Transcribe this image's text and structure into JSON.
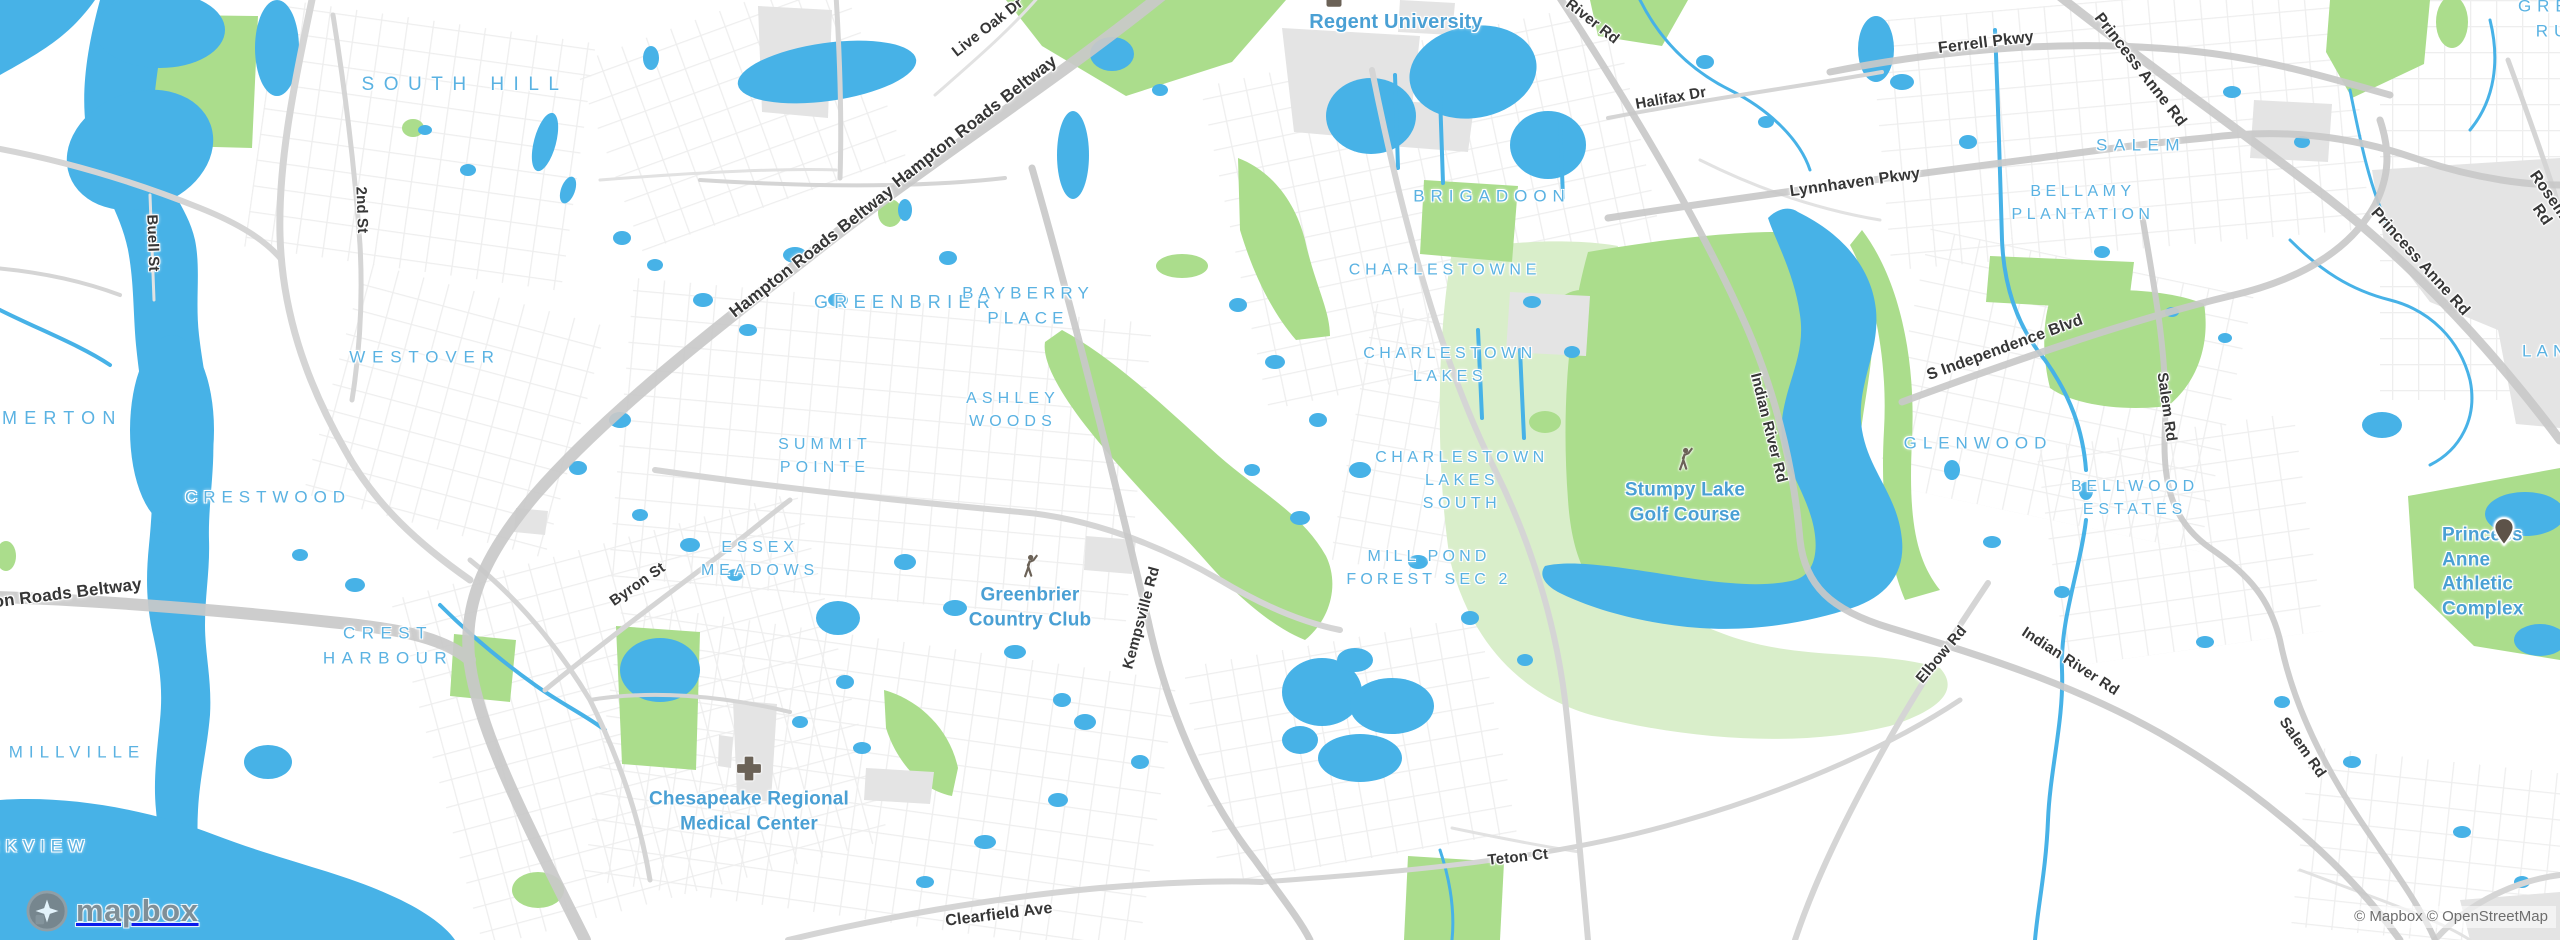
{
  "map": {
    "attribution": "© Mapbox © OpenStreetMap",
    "logo_text": "mapbox",
    "colors": {
      "water": "#47b2e7",
      "park": "#abdd8c",
      "park_light": "#d9eeca",
      "urban": "#e4e4e4",
      "road_major": "#c9c9c9",
      "road": "#d5d5d5",
      "road_minor": "#e2e2e2",
      "label_area": "#5ab2e2",
      "label_poi": "#4aa0d4",
      "label_road": "#363636",
      "icon_brown": "#6b6257",
      "pin_brown": "#5d5349",
      "attribution_gray": "#6e6e6e"
    },
    "area_labels": [
      {
        "text": "SOUTH HILL",
        "x": 465,
        "y": 85,
        "size": 19,
        "ls": 0.5
      },
      {
        "text": "MERTON",
        "x": 2,
        "y": 418,
        "size": 18,
        "ls": 0.4,
        "align": "left"
      },
      {
        "text": "WESTOVER",
        "x": 425,
        "y": 358,
        "size": 17,
        "ls": 0.4
      },
      {
        "text": "CRESTWOOD",
        "x": 268,
        "y": 498,
        "size": 17,
        "ls": 0.35
      },
      {
        "text": "CREST\nHARBOUR",
        "x": 388,
        "y": 646,
        "size": 17,
        "ls": 0.38
      },
      {
        "text": "MILLVILLE",
        "x": 77,
        "y": 753,
        "size": 17,
        "ls": 0.35
      },
      {
        "text": "PARKVIEW",
        "x": -46,
        "y": 847,
        "size": 17,
        "ls": 0.35,
        "align": "left"
      },
      {
        "text": "GREENBRIER",
        "x": 905,
        "y": 302,
        "size": 18,
        "ls": 0.35
      },
      {
        "text": "BAYBERRY\nPLACE",
        "x": 1028,
        "y": 306,
        "size": 17,
        "ls": 0.3
      },
      {
        "text": "ASHLEY\nWOODS",
        "x": 1013,
        "y": 410,
        "size": 16,
        "ls": 0.32
      },
      {
        "text": "SUMMIT\nPOINTE",
        "x": 825,
        "y": 456,
        "size": 16,
        "ls": 0.32
      },
      {
        "text": "ESSEX\nMEADOWS",
        "x": 760,
        "y": 559,
        "size": 16,
        "ls": 0.3
      },
      {
        "text": "BRIGADOON",
        "x": 1492,
        "y": 197,
        "size": 17,
        "ls": 0.35
      },
      {
        "text": "CHARLESTOWNE",
        "x": 1445,
        "y": 270,
        "size": 16,
        "ls": 0.3
      },
      {
        "text": "CHARLESTOWN\nLAKES",
        "x": 1450,
        "y": 365,
        "size": 16,
        "ls": 0.28
      },
      {
        "text": "CHARLESTOWN\nLAKES\nSOUTH",
        "x": 1462,
        "y": 481,
        "size": 16,
        "ls": 0.28
      },
      {
        "text": "MILL POND\nFOREST SEC 2",
        "x": 1429,
        "y": 568,
        "size": 16,
        "ls": 0.26
      },
      {
        "text": "GLENWOOD",
        "x": 1978,
        "y": 444,
        "size": 17,
        "ls": 0.35
      },
      {
        "text": "BELLWOOD\nESTATES",
        "x": 2135,
        "y": 498,
        "size": 16,
        "ls": 0.3
      },
      {
        "text": "SALEM",
        "x": 2141,
        "y": 146,
        "size": 17,
        "ls": 0.38
      },
      {
        "text": "BELLAMY\nPLANTATION",
        "x": 2083,
        "y": 203,
        "size": 16,
        "ls": 0.28
      },
      {
        "text": "GREEN RUN",
        "x": 2518,
        "y": 19,
        "size": 17,
        "ls": 0.35,
        "align": "left"
      },
      {
        "text": "LANDSTOWN",
        "x": 2522,
        "y": 352,
        "size": 17,
        "ls": 0.3,
        "align": "left"
      }
    ],
    "road_labels": [
      {
        "text": "Hampton Roads Beltway",
        "x": 975,
        "y": 122,
        "rot": -38,
        "size": 17
      },
      {
        "text": "Hampton Roads Beltway",
        "x": 812,
        "y": 252,
        "rot": -38,
        "size": 17
      },
      {
        "text": "Hampton Roads Beltway",
        "x": 41,
        "y": 597,
        "rot": -7,
        "size": 17
      },
      {
        "text": "Live Oak Dr",
        "x": 988,
        "y": 28,
        "rot": -38
      },
      {
        "text": "River Rd",
        "x": 1592,
        "y": 22,
        "rot": 38
      },
      {
        "text": "Ferrell Pkwy",
        "x": 1986,
        "y": 43,
        "rot": -7,
        "size": 16
      },
      {
        "text": "Princess Anne Rd",
        "x": 2140,
        "y": 70,
        "rot": 52,
        "size": 16
      },
      {
        "text": "Princess Anne Rd",
        "x": 2420,
        "y": 262,
        "rot": 48,
        "size": 16
      },
      {
        "text": "S Rosemont Rd",
        "x": 2556,
        "y": 205,
        "rot": 55,
        "size": 16
      },
      {
        "text": "Halifax Dr",
        "x": 1671,
        "y": 99,
        "rot": -10
      },
      {
        "text": "Lynnhaven Pkwy",
        "x": 1855,
        "y": 183,
        "rot": -8,
        "size": 16
      },
      {
        "text": "S Independence Blvd",
        "x": 2005,
        "y": 348,
        "rot": -20,
        "size": 16
      },
      {
        "text": "Indian River Rd",
        "x": 1768,
        "y": 428,
        "rot": 76
      },
      {
        "text": "Indian River Rd",
        "x": 2070,
        "y": 662,
        "rot": 33
      },
      {
        "text": "Salem Rd",
        "x": 2166,
        "y": 407,
        "rot": 82
      },
      {
        "text": "Salem Rd",
        "x": 2302,
        "y": 748,
        "rot": 55
      },
      {
        "text": "Elbow Rd",
        "x": 1942,
        "y": 655,
        "rot": -50
      },
      {
        "text": "Kempsville Rd",
        "x": 1142,
        "y": 618,
        "rot": -75
      },
      {
        "text": "Byron St",
        "x": 638,
        "y": 585,
        "rot": -35
      },
      {
        "text": "Clearfield Ave",
        "x": 999,
        "y": 915,
        "rot": -7,
        "size": 16
      },
      {
        "text": "Teton Ct",
        "x": 1518,
        "y": 858,
        "rot": -6
      },
      {
        "text": "2nd St",
        "x": 361,
        "y": 210,
        "rot": 88
      },
      {
        "text": "Buell St",
        "x": 152,
        "y": 243,
        "rot": 88
      }
    ],
    "poi_labels": [
      {
        "text": "Regent University",
        "x": 1396,
        "y": 22,
        "size": 20,
        "icon": "university-icon",
        "ix": 1334,
        "iy": 5
      },
      {
        "text": "Stumpy Lake\nGolf Course",
        "x": 1685,
        "y": 503,
        "icon": "golfer-icon",
        "ix": 1684,
        "iy": 464
      },
      {
        "text": "Greenbrier\nCountry Club",
        "x": 1030,
        "y": 608,
        "icon": "golfer-icon",
        "ix": 1029,
        "iy": 571
      },
      {
        "text": "Chesapeake Regional\nMedical Center",
        "x": 749,
        "y": 812,
        "icon": "hospital-cross-icon",
        "ix": 749,
        "iy": 771
      },
      {
        "text": "Princess Anne\nAthletic Complex",
        "x": 2442,
        "y": 573,
        "align": "left",
        "icon": "pin-icon",
        "ix": 2504,
        "iy": 534
      }
    ]
  }
}
